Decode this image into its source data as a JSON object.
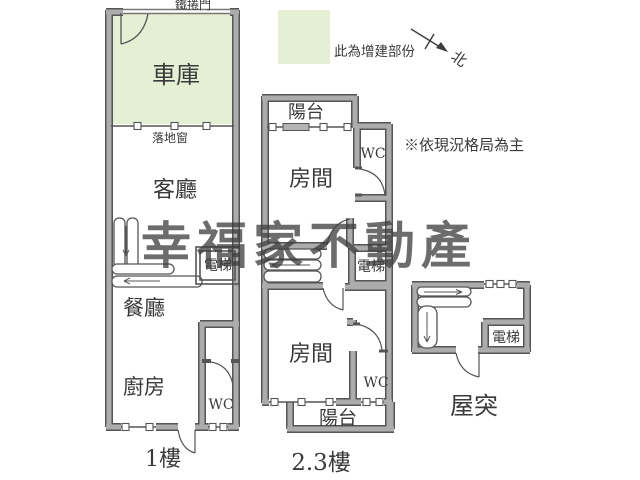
{
  "title": "floor-plan",
  "watermark": {
    "text": "幸福家不動產",
    "color": "#96a67f"
  },
  "legend": {
    "label": "此為增建部份",
    "swatch_color": "#e4efd3"
  },
  "note": "※依現況格局為主",
  "compass": {
    "label": "北"
  },
  "colors": {
    "background": "#ffffff",
    "wall_fill": "#acacac",
    "wall_edge": "#555555",
    "added_area_green": "#e4efd3",
    "line": "#444444"
  },
  "units": {
    "floor1": {
      "name_label": "1樓",
      "rooms": {
        "rolling_door": "鐵捲門",
        "garage": "車庫",
        "french_window": "落地窗",
        "living_room": "客廳",
        "elevator": "電梯",
        "dining_room": "餐廳",
        "kitchen": "廚房",
        "wc": "WC"
      }
    },
    "floor23": {
      "name_label": "2.3樓",
      "rooms": {
        "balcony_top": "陽台",
        "room_top": "房間",
        "wc_top": "WC",
        "elevator": "電梯",
        "room_bottom": "房間",
        "wc_bottom": "WC",
        "balcony_bottom": "陽台"
      }
    },
    "rooftop": {
      "name_label": "屋突",
      "rooms": {
        "elevator": "電梯"
      }
    }
  }
}
